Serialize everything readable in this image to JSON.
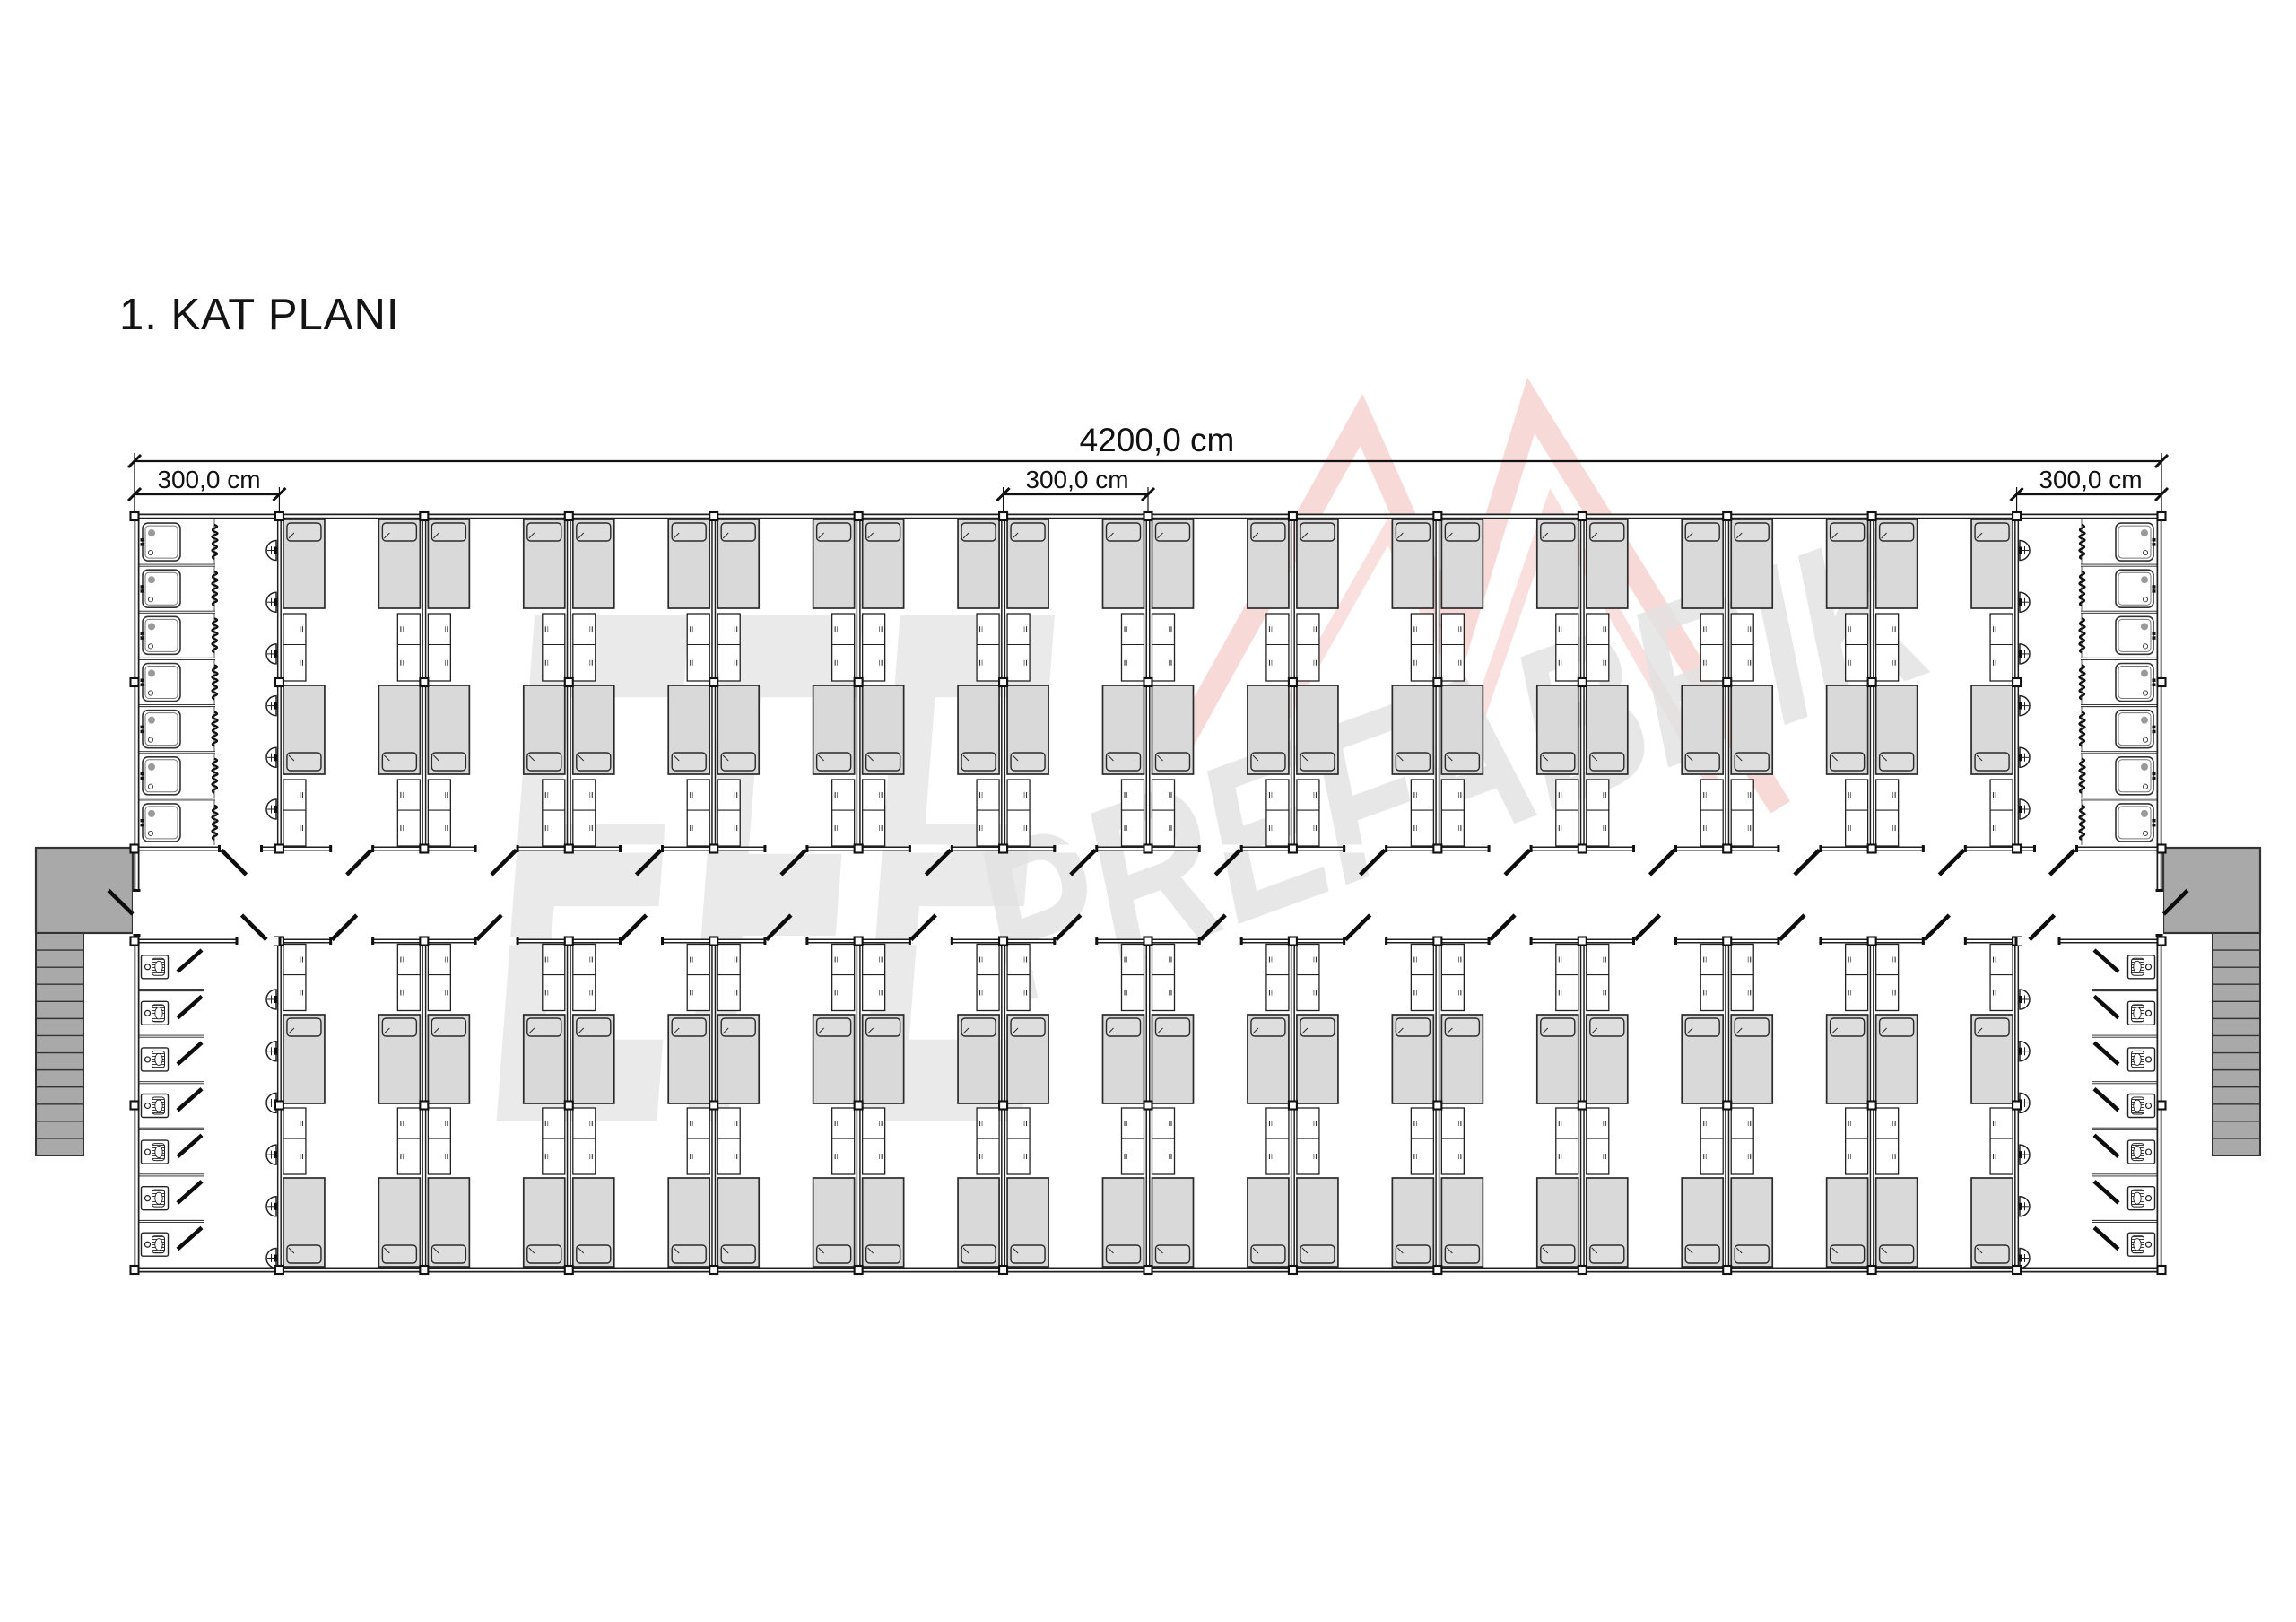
{
  "page": {
    "title": "1. KAT PLANI",
    "background": "#ffffff"
  },
  "dimensions": {
    "total": {
      "label": "4200,0 cm"
    },
    "left_module": {
      "label": "300,0 cm"
    },
    "middle_module": {
      "label": "300,0 cm"
    },
    "right_module": {
      "label": "300,0 cm"
    }
  },
  "watermark": {
    "brand_first": "EFE",
    "brand_second": "PREFABRİK",
    "text_color": "#e6e6e6",
    "logo_color": "#d9453b",
    "logo_points_outer": "1308,846 1518,468 1627,714 1707,452 1985,900",
    "logo_points_inner": "1396,860 1548,592 1648,800 1730,562 1913,878"
  },
  "plan": {
    "module_count": 14,
    "room_modules_per_row": 12,
    "room_rows": 2,
    "beds_per_room": 4,
    "wardrobes_per_room": 4,
    "shower_bathrooms": 2,
    "shower_stalls_per_bathroom": 7,
    "wc_bathrooms": 2,
    "wc_cubicles_per_bathroom": 7,
    "washbasins_per_bathroom": 6,
    "staircases": 2,
    "stair_treads_per_flight": 13,
    "colors": {
      "line": "#1f1f1f",
      "bed_fill": "#d9d9d9",
      "pillow_fill": "#dedede",
      "stair_fill": "#a9a9a9",
      "furniture_fill": "#ffffff"
    }
  }
}
